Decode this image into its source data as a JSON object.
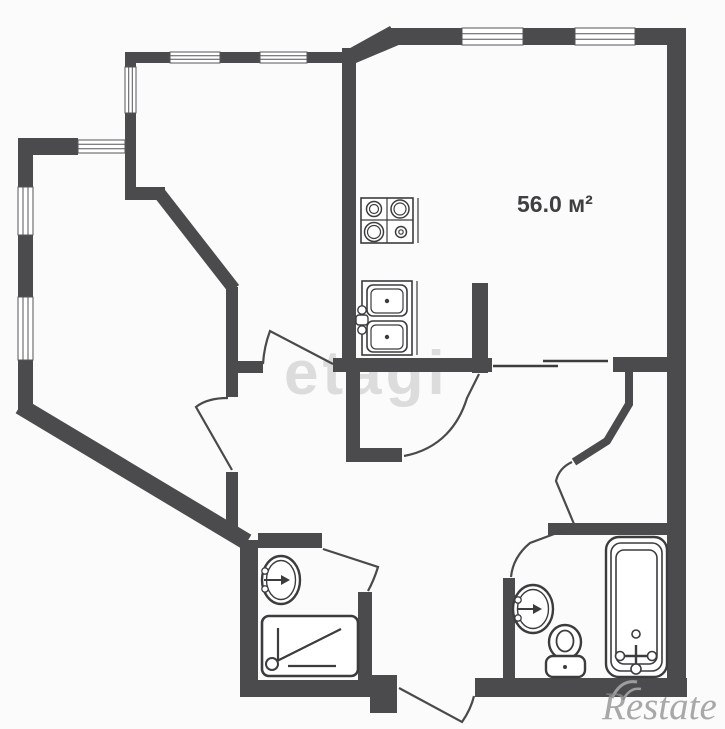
{
  "canvas": {
    "w": 725,
    "h": 725,
    "bg": "#fbfbfb"
  },
  "colors": {
    "wall": "#4b4b4d",
    "stroke": "#3c3c3e",
    "door": "#4a4a4c",
    "white": "#ffffff",
    "winline": "#55555a",
    "wm_corner": "#9d9d9d"
  },
  "area_label": {
    "text": "56.0 м²",
    "x": 517,
    "y": 191,
    "size": 23
  },
  "watermark_center": {
    "text": "etagi",
    "x": 284,
    "y": 338,
    "size": 62,
    "color": "#dcdcdc"
  },
  "watermark_corner": {
    "text": "Restate",
    "x": 602,
    "y": 684,
    "size": 39,
    "color": "rgba(140,140,140,0.75)"
  },
  "shapes": [
    {
      "n": "wall-top-main",
      "t": "rect",
      "x": 388,
      "y": 28,
      "w": 298,
      "h": 17,
      "f": "wall"
    },
    {
      "n": "wall-top-diagonal",
      "t": "poly",
      "pts": "343,52 390,26 401,44 356,63",
      "f": "wall"
    },
    {
      "n": "wall-topleft-room-top",
      "t": "rect",
      "x": 125,
      "y": 52,
      "w": 228,
      "h": 11,
      "f": "wall"
    },
    {
      "n": "wall-topleft-room-left",
      "t": "rect",
      "x": 125,
      "y": 52,
      "w": 11,
      "h": 148,
      "f": "wall"
    },
    {
      "n": "wall-topleft-jog",
      "t": "rect",
      "x": 125,
      "y": 187,
      "w": 40,
      "h": 13,
      "f": "wall"
    },
    {
      "n": "wall-inner-diagonal",
      "t": "line",
      "x1": 160,
      "y1": 194,
      "x2": 234,
      "y2": 289,
      "s": "wall",
      "sw": 13
    },
    {
      "n": "wall-hall-left-upper",
      "t": "rect",
      "x": 226,
      "y": 287,
      "w": 12,
      "h": 110,
      "f": "wall"
    },
    {
      "n": "wall-hall-stub",
      "t": "rect",
      "x": 238,
      "y": 361,
      "w": 25,
      "h": 12,
      "f": "wall"
    },
    {
      "n": "wall-hall-top",
      "t": "rect",
      "x": 333,
      "y": 358,
      "w": 159,
      "h": 14,
      "f": "wall"
    },
    {
      "n": "wall-kitchen-partition-upper",
      "t": "rect",
      "x": 342,
      "y": 48,
      "w": 14,
      "h": 310,
      "f": "wall"
    },
    {
      "n": "wall-kitchen-partition-lower",
      "t": "rect",
      "x": 346,
      "y": 372,
      "w": 14,
      "h": 83,
      "f": "wall"
    },
    {
      "n": "wall-kitchen-foot",
      "t": "rect",
      "x": 346,
      "y": 448,
      "w": 56,
      "h": 14,
      "f": "wall"
    },
    {
      "n": "wall-leftroom-top",
      "t": "rect",
      "x": 18,
      "y": 138,
      "w": 60,
      "h": 17,
      "f": "wall"
    },
    {
      "n": "wall-left-exterior",
      "t": "rect",
      "x": 18,
      "y": 138,
      "w": 15,
      "h": 276,
      "f": "wall"
    },
    {
      "n": "wall-outer-diagonal",
      "t": "line",
      "x1": 20,
      "y1": 406,
      "x2": 247,
      "y2": 542,
      "s": "wall",
      "sw": 17
    },
    {
      "n": "wall-hall-left-lower",
      "t": "rect",
      "x": 226,
      "y": 472,
      "w": 12,
      "h": 62,
      "f": "wall"
    },
    {
      "n": "wall-shower-top",
      "t": "rect",
      "x": 258,
      "y": 533,
      "w": 64,
      "h": 15,
      "f": "wall"
    },
    {
      "n": "wall-shower-left",
      "t": "rect",
      "x": 240,
      "y": 540,
      "w": 18,
      "h": 157,
      "f": "wall"
    },
    {
      "n": "wall-bottom-left",
      "t": "rect",
      "x": 240,
      "y": 680,
      "w": 157,
      "h": 17,
      "f": "wall"
    },
    {
      "n": "wall-vestibule-block",
      "t": "rect",
      "x": 370,
      "y": 675,
      "w": 27,
      "h": 38,
      "f": "wall"
    },
    {
      "n": "wall-shower-right",
      "t": "rect",
      "x": 358,
      "y": 592,
      "w": 14,
      "h": 88,
      "f": "wall"
    },
    {
      "n": "wall-bottom-right",
      "t": "rect",
      "x": 475,
      "y": 678,
      "w": 212,
      "h": 19,
      "f": "wall"
    },
    {
      "n": "wall-bath-left",
      "t": "rect",
      "x": 503,
      "y": 578,
      "w": 12,
      "h": 100,
      "f": "wall"
    },
    {
      "n": "wall-bath-top",
      "t": "rect",
      "x": 548,
      "y": 523,
      "w": 119,
      "h": 12,
      "f": "wall"
    },
    {
      "n": "wall-right-exterior",
      "t": "rect",
      "x": 667,
      "y": 28,
      "w": 19,
      "h": 669,
      "f": "wall"
    },
    {
      "n": "wall-bedroom-block",
      "t": "rect",
      "x": 613,
      "y": 357,
      "w": 54,
      "h": 15,
      "f": "wall"
    },
    {
      "n": "wall-bedroom-curve",
      "t": "path",
      "d": "M629,372 L629,404 L607,441 L574,462",
      "s": "wall",
      "sw": 8,
      "f": "none"
    },
    {
      "n": "wall-pilaster-stub",
      "t": "rect",
      "x": 472,
      "y": 283,
      "w": 16,
      "h": 90,
      "f": "wall"
    },
    {
      "n": "window-top-1",
      "t": "rect",
      "x": 462,
      "y": 28,
      "w": 61,
      "h": 17,
      "f": "white",
      "s": "winline",
      "sw": 1
    },
    {
      "n": "window-top-1-line",
      "t": "line",
      "x1": 462,
      "y1": 33.7,
      "x2": 523,
      "y2": 33.7,
      "s": "winline",
      "sw": 1
    },
    {
      "n": "window-top-1-line",
      "t": "line",
      "x1": 462,
      "y1": 39.3,
      "x2": 523,
      "y2": 39.3,
      "s": "winline",
      "sw": 1
    },
    {
      "n": "window-top-2",
      "t": "rect",
      "x": 575,
      "y": 28,
      "w": 60,
      "h": 17,
      "f": "white",
      "s": "winline",
      "sw": 1
    },
    {
      "n": "window-top-2-line",
      "t": "line",
      "x1": 575,
      "y1": 33.7,
      "x2": 635,
      "y2": 33.7,
      "s": "winline",
      "sw": 1
    },
    {
      "n": "window-top-2-line",
      "t": "line",
      "x1": 575,
      "y1": 39.3,
      "x2": 635,
      "y2": 39.3,
      "s": "winline",
      "sw": 1
    },
    {
      "n": "window-topleft-1",
      "t": "rect",
      "x": 170,
      "y": 52,
      "w": 50,
      "h": 11,
      "f": "white",
      "s": "winline",
      "sw": 1
    },
    {
      "n": "window-topleft-1-line",
      "t": "line",
      "x1": 170,
      "y1": 55.7,
      "x2": 220,
      "y2": 55.7,
      "s": "winline",
      "sw": 1
    },
    {
      "n": "window-topleft-1-line",
      "t": "line",
      "x1": 170,
      "y1": 59.3,
      "x2": 220,
      "y2": 59.3,
      "s": "winline",
      "sw": 1
    },
    {
      "n": "window-topleft-2",
      "t": "rect",
      "x": 260,
      "y": 52,
      "w": 47,
      "h": 11,
      "f": "white",
      "s": "winline",
      "sw": 1
    },
    {
      "n": "window-topleft-2-line",
      "t": "line",
      "x1": 260,
      "y1": 55.7,
      "x2": 307,
      "y2": 55.7,
      "s": "winline",
      "sw": 1
    },
    {
      "n": "window-topleft-2-line",
      "t": "line",
      "x1": 260,
      "y1": 59.3,
      "x2": 307,
      "y2": 59.3,
      "s": "winline",
      "sw": 1
    },
    {
      "n": "window-corner-vertical",
      "t": "rect",
      "x": 125,
      "y": 67,
      "w": 11,
      "h": 46,
      "f": "white",
      "s": "winline",
      "sw": 1
    },
    {
      "n": "window-corner-vertical-line",
      "t": "line",
      "x1": 128.7,
      "y1": 67,
      "x2": 128.7,
      "y2": 113,
      "s": "winline",
      "sw": 1
    },
    {
      "n": "window-corner-vertical-line",
      "t": "line",
      "x1": 132.3,
      "y1": 67,
      "x2": 132.3,
      "y2": 113,
      "s": "winline",
      "sw": 1
    },
    {
      "n": "window-leftroom-top",
      "t": "rect",
      "x": 78,
      "y": 140,
      "w": 47,
      "h": 13,
      "f": "white",
      "s": "winline",
      "sw": 1
    },
    {
      "n": "window-leftroom-top-line",
      "t": "line",
      "x1": 78,
      "y1": 144.3,
      "x2": 125,
      "y2": 144.3,
      "s": "winline",
      "sw": 1
    },
    {
      "n": "window-leftroom-top-line",
      "t": "line",
      "x1": 78,
      "y1": 148.7,
      "x2": 125,
      "y2": 148.7,
      "s": "winline",
      "sw": 1
    },
    {
      "n": "window-left-1",
      "t": "rect",
      "x": 18,
      "y": 187,
      "w": 15,
      "h": 48,
      "f": "white",
      "s": "winline",
      "sw": 1
    },
    {
      "n": "window-left-1-line",
      "t": "line",
      "x1": 23,
      "y1": 187,
      "x2": 23,
      "y2": 235,
      "s": "winline",
      "sw": 1
    },
    {
      "n": "window-left-1-line",
      "t": "line",
      "x1": 28,
      "y1": 187,
      "x2": 28,
      "y2": 235,
      "s": "winline",
      "sw": 1
    },
    {
      "n": "window-left-2",
      "t": "rect",
      "x": 18,
      "y": 297,
      "w": 15,
      "h": 63,
      "f": "white",
      "s": "winline",
      "sw": 1
    },
    {
      "n": "window-left-2-line",
      "t": "line",
      "x1": 23,
      "y1": 297,
      "x2": 23,
      "y2": 360,
      "s": "winline",
      "sw": 1
    },
    {
      "n": "window-left-2-line",
      "t": "line",
      "x1": 28,
      "y1": 297,
      "x2": 28,
      "y2": 360,
      "s": "winline",
      "sw": 1
    },
    {
      "n": "passage-line-1",
      "t": "line",
      "x1": 493,
      "y1": 366,
      "x2": 558,
      "y2": 366,
      "s": "stroke",
      "sw": 2.5
    },
    {
      "n": "passage-line-2",
      "t": "line",
      "x1": 543,
      "y1": 361,
      "x2": 608,
      "y2": 361,
      "s": "stroke",
      "sw": 2.5
    },
    {
      "n": "door-topleft-room",
      "t": "path",
      "d": "M333,364 L270,331 Q264,347 263,364",
      "s": "door",
      "sw": 2.2,
      "f": "none"
    },
    {
      "n": "door-leftroom",
      "t": "path",
      "d": "M232,470 L196,407 Q207,398 228,398",
      "s": "door",
      "sw": 2.2,
      "f": "none"
    },
    {
      "n": "door-kitchen-passage",
      "t": "path",
      "d": "M404,456 C441,449 459,424 467,398 L479,374",
      "s": "door",
      "sw": 2.2,
      "f": "none"
    },
    {
      "n": "door-bedroom",
      "t": "path",
      "d": "M574,524 L556,481 Q559,468 572,462",
      "s": "door",
      "sw": 2.2,
      "f": "none"
    },
    {
      "n": "door-bathroom",
      "t": "path",
      "d": "M573,527 L530,543 Q513,557 511,577",
      "s": "door",
      "sw": 2.2,
      "f": "none"
    },
    {
      "n": "door-entrance",
      "t": "path",
      "d": "M399,688 L462,722 Q471,709 474,696",
      "s": "door",
      "sw": 2.2,
      "f": "none"
    },
    {
      "n": "door-shower",
      "t": "path",
      "d": "M323,549 L378,567 Q374,580 368,591",
      "s": "door",
      "sw": 2.2,
      "f": "none"
    },
    {
      "n": "stove-body",
      "t": "rect",
      "x": 361,
      "y": 198,
      "w": 52,
      "h": 45,
      "f": "white",
      "s": "stroke",
      "sw": 1.6
    },
    {
      "n": "stove-edge",
      "t": "line",
      "x1": 418,
      "y1": 198,
      "x2": 418,
      "y2": 243,
      "s": "stroke",
      "sw": 1.2
    },
    {
      "n": "stove-divider-v",
      "t": "line",
      "x1": 387,
      "y1": 198,
      "x2": 387,
      "y2": 243,
      "s": "stroke",
      "sw": 1.2
    },
    {
      "n": "stove-divider-h",
      "t": "line",
      "x1": 361,
      "y1": 220,
      "x2": 413,
      "y2": 220,
      "s": "stroke",
      "sw": 1.2
    },
    {
      "n": "stove-burner",
      "t": "circle",
      "cx": 374,
      "cy": 209,
      "r": 7.5,
      "s": "stroke",
      "sw": 1.5,
      "f": "none"
    },
    {
      "n": "stove-burner",
      "t": "circle",
      "cx": 374,
      "cy": 209,
      "r": 4.5,
      "s": "stroke",
      "sw": 1.2,
      "f": "none"
    },
    {
      "n": "stove-burner",
      "t": "circle",
      "cx": 400,
      "cy": 209,
      "r": 9,
      "s": "stroke",
      "sw": 1.5,
      "f": "none"
    },
    {
      "n": "stove-burner",
      "t": "circle",
      "cx": 400,
      "cy": 209,
      "r": 6,
      "s": "stroke",
      "sw": 1.2,
      "f": "none"
    },
    {
      "n": "stove-burner",
      "t": "circle",
      "cx": 374,
      "cy": 232,
      "r": 9.5,
      "s": "stroke",
      "sw": 1.5,
      "f": "none"
    },
    {
      "n": "stove-burner",
      "t": "circle",
      "cx": 374,
      "cy": 232,
      "r": 6.5,
      "s": "stroke",
      "sw": 1.2,
      "f": "none"
    },
    {
      "n": "stove-burner",
      "t": "circle",
      "cx": 401,
      "cy": 232,
      "r": 5.5,
      "s": "stroke",
      "sw": 1.5,
      "f": "none"
    },
    {
      "n": "stove-burner",
      "t": "circle",
      "cx": 401,
      "cy": 232,
      "r": 2.2,
      "s": "stroke",
      "sw": 1.2,
      "f": "none"
    },
    {
      "n": "sink-body",
      "t": "rect",
      "x": 362,
      "y": 281,
      "w": 50,
      "h": 74,
      "f": "white",
      "s": "stroke",
      "sw": 1.6
    },
    {
      "n": "sink-edge",
      "t": "line",
      "x1": 417,
      "y1": 281,
      "x2": 417,
      "y2": 355,
      "s": "stroke",
      "sw": 1.2
    },
    {
      "n": "sink-bowl",
      "t": "rect",
      "x": 367,
      "y": 285,
      "w": 40,
      "h": 31,
      "rx": 6,
      "f": "white",
      "s": "stroke",
      "sw": 1.6
    },
    {
      "n": "sink-bowl-inner",
      "t": "rect",
      "x": 371,
      "y": 289,
      "w": 32,
      "h": 24,
      "rx": 5,
      "f": "none",
      "s": "stroke",
      "sw": 1.2
    },
    {
      "n": "sink-drain",
      "t": "circle",
      "cx": 387,
      "cy": 301,
      "r": 2.2,
      "f": "stroke"
    },
    {
      "n": "sink-bowl",
      "t": "rect",
      "x": 367,
      "y": 321,
      "w": 40,
      "h": 31,
      "rx": 6,
      "f": "white",
      "s": "stroke",
      "sw": 1.6
    },
    {
      "n": "sink-bowl-inner",
      "t": "rect",
      "x": 371,
      "y": 325,
      "w": 32,
      "h": 24,
      "rx": 5,
      "f": "none",
      "s": "stroke",
      "sw": 1.2
    },
    {
      "n": "sink-drain",
      "t": "circle",
      "cx": 387,
      "cy": 337,
      "r": 2.2,
      "f": "stroke"
    },
    {
      "n": "sink-faucet-handle",
      "t": "circle",
      "cx": 362,
      "cy": 310,
      "r": 4.2,
      "f": "white",
      "s": "stroke",
      "sw": 1.4
    },
    {
      "n": "sink-faucet-handle",
      "t": "circle",
      "cx": 362,
      "cy": 330,
      "r": 4.2,
      "f": "white",
      "s": "stroke",
      "sw": 1.4
    },
    {
      "n": "sink-faucet-spout",
      "t": "rect",
      "x": 356,
      "y": 315,
      "w": 12,
      "h": 10,
      "rx": 3,
      "f": "white",
      "s": "stroke",
      "sw": 1.4
    },
    {
      "n": "shower-tray",
      "t": "rect",
      "x": 262,
      "y": 616,
      "w": 96,
      "h": 60,
      "rx": 7,
      "f": "white",
      "s": "stroke",
      "sw": 2.6
    },
    {
      "n": "shower-tray-line-v",
      "t": "line",
      "x1": 278,
      "y1": 628,
      "x2": 278,
      "y2": 661,
      "s": "stroke",
      "sw": 2.2
    },
    {
      "n": "shower-tray-line-h",
      "t": "line",
      "x1": 288,
      "y1": 666,
      "x2": 336,
      "y2": 666,
      "s": "stroke",
      "sw": 2.2
    },
    {
      "n": "shower-tray-diagonal",
      "t": "line",
      "x1": 277,
      "y1": 661,
      "x2": 341,
      "y2": 629,
      "s": "stroke",
      "sw": 2.2
    },
    {
      "n": "shower-drain",
      "t": "circle",
      "cx": 272,
      "cy": 664,
      "r": 6,
      "f": "white",
      "s": "stroke",
      "sw": 2
    },
    {
      "n": "washbasin-shower",
      "t": "ellipse",
      "cx": 281,
      "cy": 580,
      "rx": 19,
      "ry": 24,
      "f": "white",
      "s": "stroke",
      "sw": 2.4
    },
    {
      "n": "washbasin-shower-inner",
      "t": "ellipse",
      "cx": 281,
      "cy": 580,
      "rx": 14.5,
      "ry": 19.5,
      "f": "none",
      "s": "stroke",
      "sw": 1.4
    },
    {
      "n": "washbasin-shower-tap",
      "t": "line",
      "x1": 264,
      "y1": 580,
      "x2": 285,
      "y2": 580,
      "s": "stroke",
      "sw": 2
    },
    {
      "n": "washbasin-shower-tap-arrow",
      "t": "poly",
      "pts": "290,580 281,575 281,585",
      "f": "stroke"
    },
    {
      "n": "washbasin-shower-handle",
      "t": "circle",
      "cx": 265,
      "cy": 571,
      "r": 3.2,
      "f": "white",
      "s": "stroke",
      "sw": 1.3
    },
    {
      "n": "washbasin-shower-handle",
      "t": "circle",
      "cx": 265,
      "cy": 589,
      "r": 3.2,
      "f": "white",
      "s": "stroke",
      "sw": 1.3
    },
    {
      "n": "washbasin-bath",
      "t": "ellipse",
      "cx": 533,
      "cy": 609,
      "rx": 20,
      "ry": 24,
      "f": "white",
      "s": "stroke",
      "sw": 2.4
    },
    {
      "n": "washbasin-bath-inner",
      "t": "ellipse",
      "cx": 533,
      "cy": 609,
      "rx": 15.5,
      "ry": 19.5,
      "f": "none",
      "s": "stroke",
      "sw": 1.4
    },
    {
      "n": "washbasin-bath-tap",
      "t": "line",
      "x1": 517,
      "y1": 609,
      "x2": 537,
      "y2": 609,
      "s": "stroke",
      "sw": 2
    },
    {
      "n": "washbasin-bath-tap-arrow",
      "t": "poly",
      "pts": "542,609 533,604 533,614",
      "f": "stroke"
    },
    {
      "n": "washbasin-bath-handle",
      "t": "circle",
      "cx": 518,
      "cy": 600,
      "r": 3.2,
      "f": "white",
      "s": "stroke",
      "sw": 1.3
    },
    {
      "n": "washbasin-bath-handle",
      "t": "circle",
      "cx": 518,
      "cy": 618,
      "r": 3.2,
      "f": "white",
      "s": "stroke",
      "sw": 1.3
    },
    {
      "n": "toilet-bowl",
      "t": "ellipse",
      "cx": 565,
      "cy": 642,
      "rx": 16,
      "ry": 17,
      "f": "white",
      "s": "stroke",
      "sw": 2.4
    },
    {
      "n": "toilet-bowl-inner",
      "t": "ellipse",
      "cx": 565,
      "cy": 641,
      "rx": 8.5,
      "ry": 10.5,
      "f": "none",
      "s": "stroke",
      "sw": 1.8
    },
    {
      "n": "toilet-tank",
      "t": "rect",
      "x": 546,
      "y": 656,
      "w": 39,
      "h": 21,
      "rx": 7,
      "f": "white",
      "s": "stroke",
      "sw": 2.4
    },
    {
      "n": "toilet-button",
      "t": "circle",
      "cx": 565,
      "cy": 667,
      "r": 2,
      "f": "stroke"
    },
    {
      "n": "bathtub-outer",
      "t": "rect",
      "x": 606,
      "y": 537,
      "w": 61,
      "h": 140,
      "rx": 13,
      "f": "white",
      "s": "stroke",
      "sw": 2.4
    },
    {
      "n": "bathtub-middle",
      "t": "rect",
      "x": 611,
      "y": 543,
      "w": 51,
      "h": 128,
      "rx": 10,
      "f": "none",
      "s": "stroke",
      "sw": 1.6
    },
    {
      "n": "bathtub-inner",
      "t": "rect",
      "x": 616,
      "y": 550,
      "w": 41,
      "h": 114,
      "rx": 8,
      "f": "none",
      "s": "stroke",
      "sw": 1.6
    },
    {
      "n": "bathtub-drain",
      "t": "circle",
      "cx": 636,
      "cy": 634,
      "r": 4,
      "f": "none",
      "s": "stroke",
      "sw": 1.6
    },
    {
      "n": "bathtub-mixer-bar",
      "t": "line",
      "x1": 620,
      "y1": 656,
      "x2": 652,
      "y2": 656,
      "s": "stroke",
      "sw": 2.4
    },
    {
      "n": "bathtub-mixer-stem",
      "t": "line",
      "x1": 636,
      "y1": 645,
      "x2": 636,
      "y2": 669,
      "s": "stroke",
      "sw": 2.4
    },
    {
      "n": "bathtub-mixer-knob",
      "t": "circle",
      "cx": 620,
      "cy": 656,
      "r": 4.5,
      "f": "white",
      "s": "stroke",
      "sw": 1.6
    },
    {
      "n": "bathtub-mixer-knob",
      "t": "circle",
      "cx": 652,
      "cy": 656,
      "r": 4.5,
      "f": "white",
      "s": "stroke",
      "sw": 1.6
    },
    {
      "n": "bathtub-mixer-knob",
      "t": "circle",
      "cx": 636,
      "cy": 669,
      "r": 5,
      "f": "white",
      "s": "stroke",
      "sw": 1.6
    },
    {
      "n": "restate-swoosh",
      "t": "path",
      "d": "M612,698 Q621,679 637,682",
      "s": "wm_corner",
      "sw": 3,
      "f": "none"
    },
    {
      "n": "restate-swoosh",
      "t": "path",
      "d": "M623,700 Q630,687 641,689",
      "s": "wm_corner",
      "sw": 2.5,
      "f": "none"
    }
  ]
}
